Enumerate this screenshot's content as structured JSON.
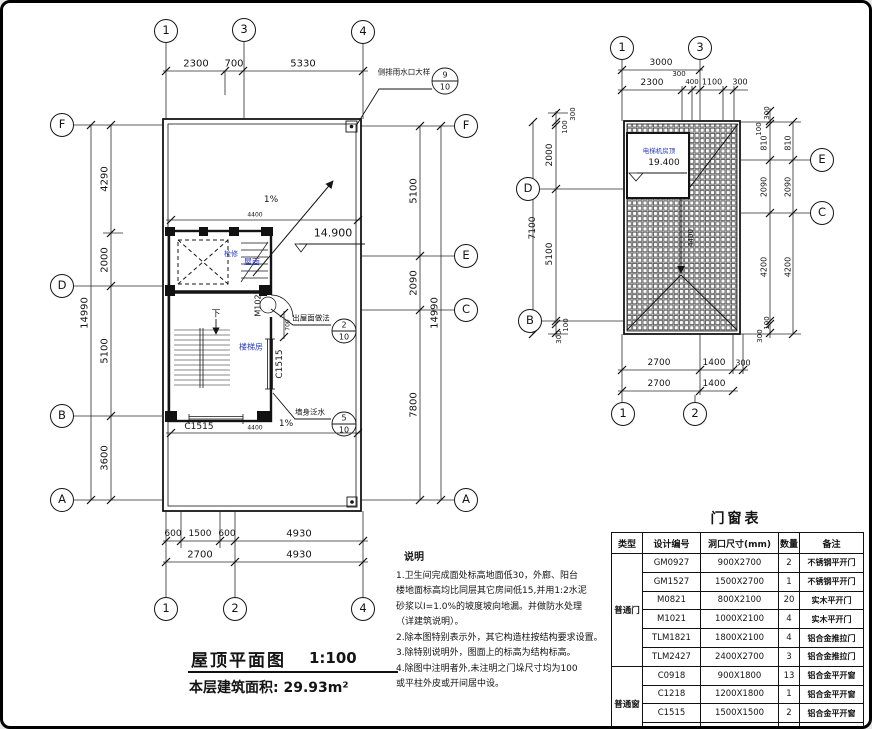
{
  "left_plan": {
    "axes": {
      "top": [
        "1",
        "3",
        "4"
      ],
      "bottom": [
        "1",
        "2",
        "4"
      ],
      "left": [
        "F",
        "D",
        "B",
        "A"
      ],
      "right": [
        "F",
        "E",
        "C",
        "A"
      ]
    },
    "dims": {
      "top": [
        "2300",
        "700",
        "5330"
      ],
      "left": [
        "4290",
        "2000",
        "5100",
        "3600"
      ],
      "left_total": "14990",
      "right": [
        "5100",
        "2090",
        "7800"
      ],
      "right_total": "14990",
      "bottom_row1": [
        "600",
        "1500",
        "600",
        "4930"
      ],
      "bottom_row2": [
        "2700",
        "4930"
      ],
      "inner_top": "4400",
      "inner_bottom": "4400",
      "door_side": "700"
    },
    "labels": {
      "slope_top": "1%",
      "slope_bottom": "1%",
      "elevation": "14.900",
      "roof": "屋面",
      "inspection": "检修",
      "stair_room": "楼梯房",
      "down": "下",
      "door": "M1021",
      "window_side": "C1515",
      "window_bottom": "C1515"
    },
    "callouts": [
      {
        "text": "侧排雨水口大样",
        "num": "9",
        "den": "10"
      },
      {
        "text": "出屋面做法",
        "num": "2",
        "den": "10"
      },
      {
        "text": "墙身泛水",
        "num": "5",
        "den": "10"
      }
    ]
  },
  "right_plan": {
    "axes": {
      "top": [
        "1",
        "3"
      ],
      "bottom": [
        "1",
        "2"
      ],
      "left": [
        "D",
        "B"
      ],
      "right": [
        "E",
        "C"
      ]
    },
    "dims": {
      "top_row1": "3000",
      "top_row2": [
        "2300",
        "300",
        "400",
        "1100",
        "300"
      ],
      "left": [
        "300",
        "100",
        "2000",
        "5100",
        "100",
        "300"
      ],
      "left_total": "7100",
      "right_inner": [
        "300",
        "100",
        "810",
        "2090",
        "4200",
        "100",
        "300"
      ],
      "right_outer": [
        "810",
        "2090",
        "4200"
      ],
      "bottom_row1": [
        "2700",
        "1400",
        "300"
      ],
      "bottom_row2": [
        "2700",
        "1400"
      ],
      "ridge": "4400"
    },
    "labels": {
      "room": "电梯机房顶",
      "elevation": "19.400"
    }
  },
  "title_block": {
    "title": "屋顶平面图",
    "scale": "1:100",
    "area": "本层建筑面积: 29.93m²"
  },
  "notes": {
    "heading": "说明",
    "lines": [
      "1.卫生间完成面处标高地面低30，外廊、阳台",
      "楼地面标高均比同层其它房间低15,并用1:2水泥",
      "砂浆以I=1.0%的坡度坡向地漏。并做防水处理",
      "（详建筑说明）。",
      "2.除本图特别表示外，其它构造柱按结构要求设置。",
      "3.除特别说明外，图面上的标高为结构标高。",
      "4.除图中注明者外,未注明之门垛尺寸均为100",
      "或平柱外皮或开间居中设。"
    ]
  },
  "schedule": {
    "title": "门窗表",
    "headers": [
      "类型",
      "设计编号",
      "洞口尺寸(mm)",
      "数量",
      "备注"
    ],
    "groups": [
      {
        "type": "普通门",
        "rows": [
          [
            "GM0927",
            "900X2700",
            "2",
            "不锈钢平开门"
          ],
          [
            "GM1527",
            "1500X2700",
            "1",
            "不锈钢平开门"
          ],
          [
            "M0821",
            "800X2100",
            "20",
            "实木平开门"
          ],
          [
            "M1021",
            "1000X2100",
            "4",
            "实木平开门"
          ],
          [
            "TLM1821",
            "1800X2100",
            "4",
            "铝合金推拉门"
          ],
          [
            "TLM2427",
            "2400X2700",
            "3",
            "铝合金推拉门"
          ]
        ]
      },
      {
        "type": "普通窗",
        "rows": [
          [
            "C0918",
            "900X1800",
            "13",
            "铝合金平开窗"
          ],
          [
            "C1218",
            "1200X1800",
            "1",
            "铝合金平开窗"
          ],
          [
            "C1515",
            "1500X1500",
            "2",
            "铝合金平开窗"
          ],
          [
            "C1518",
            "1500X1800",
            "14",
            "铝合金平开窗"
          ]
        ]
      }
    ]
  },
  "colors": {
    "line": "#141414",
    "accent_label": "#2a3cc0",
    "paper": "#ffffff"
  }
}
